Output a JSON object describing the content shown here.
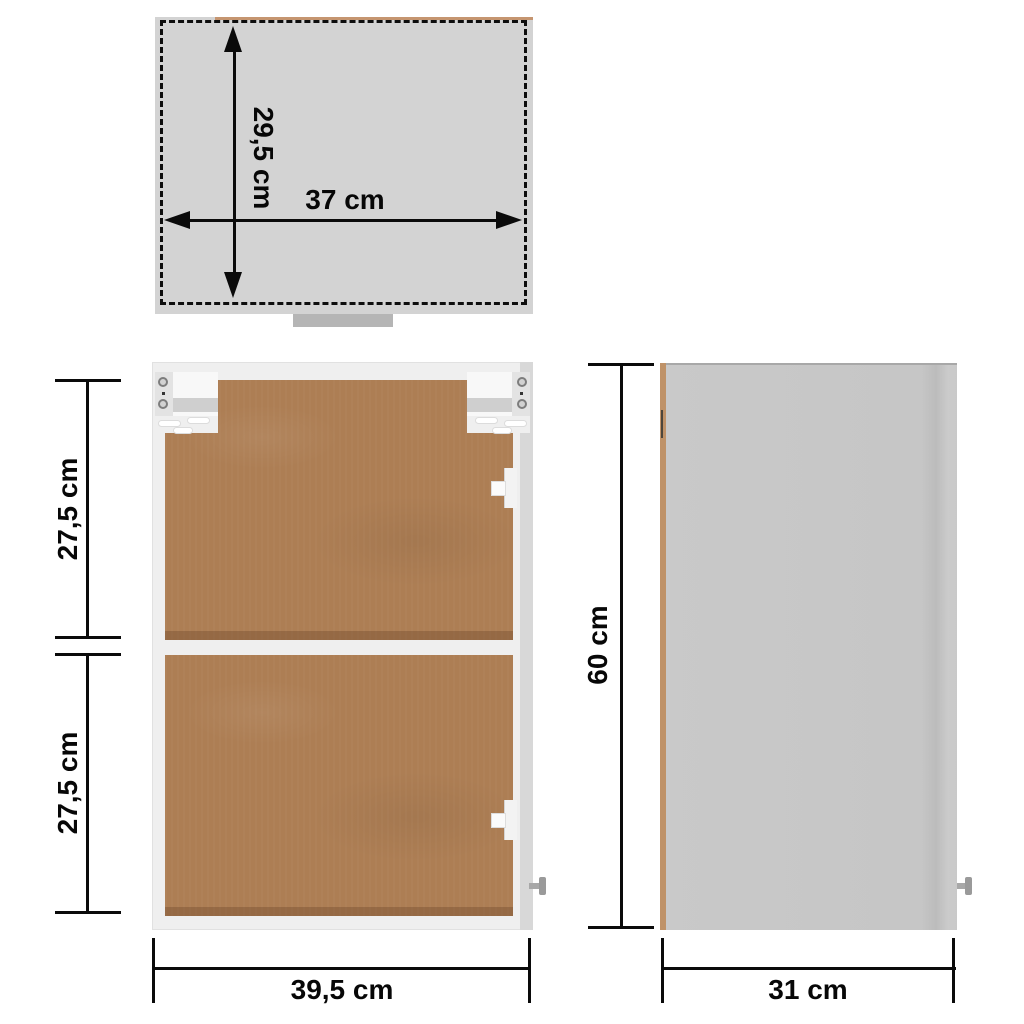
{
  "labels": {
    "top_view_depth": "29,5 cm",
    "top_view_width": "37 cm",
    "front_upper_height": "27,5 cm",
    "front_lower_height": "27,5 cm",
    "front_width": "39,5 cm",
    "side_height": "60 cm",
    "side_depth": "31 cm"
  },
  "colors": {
    "background": "#ffffff",
    "dimension_ink": "#0a0a0a",
    "top_panel_gray": "#d3d3d3",
    "carcass_white": "#efefef",
    "hardboard_brown": "#ad7e54",
    "side_panel_gray": "#c6c6c6",
    "wood_edge_tan": "#c59570",
    "hardware_gray": "#9a9a9a"
  }
}
